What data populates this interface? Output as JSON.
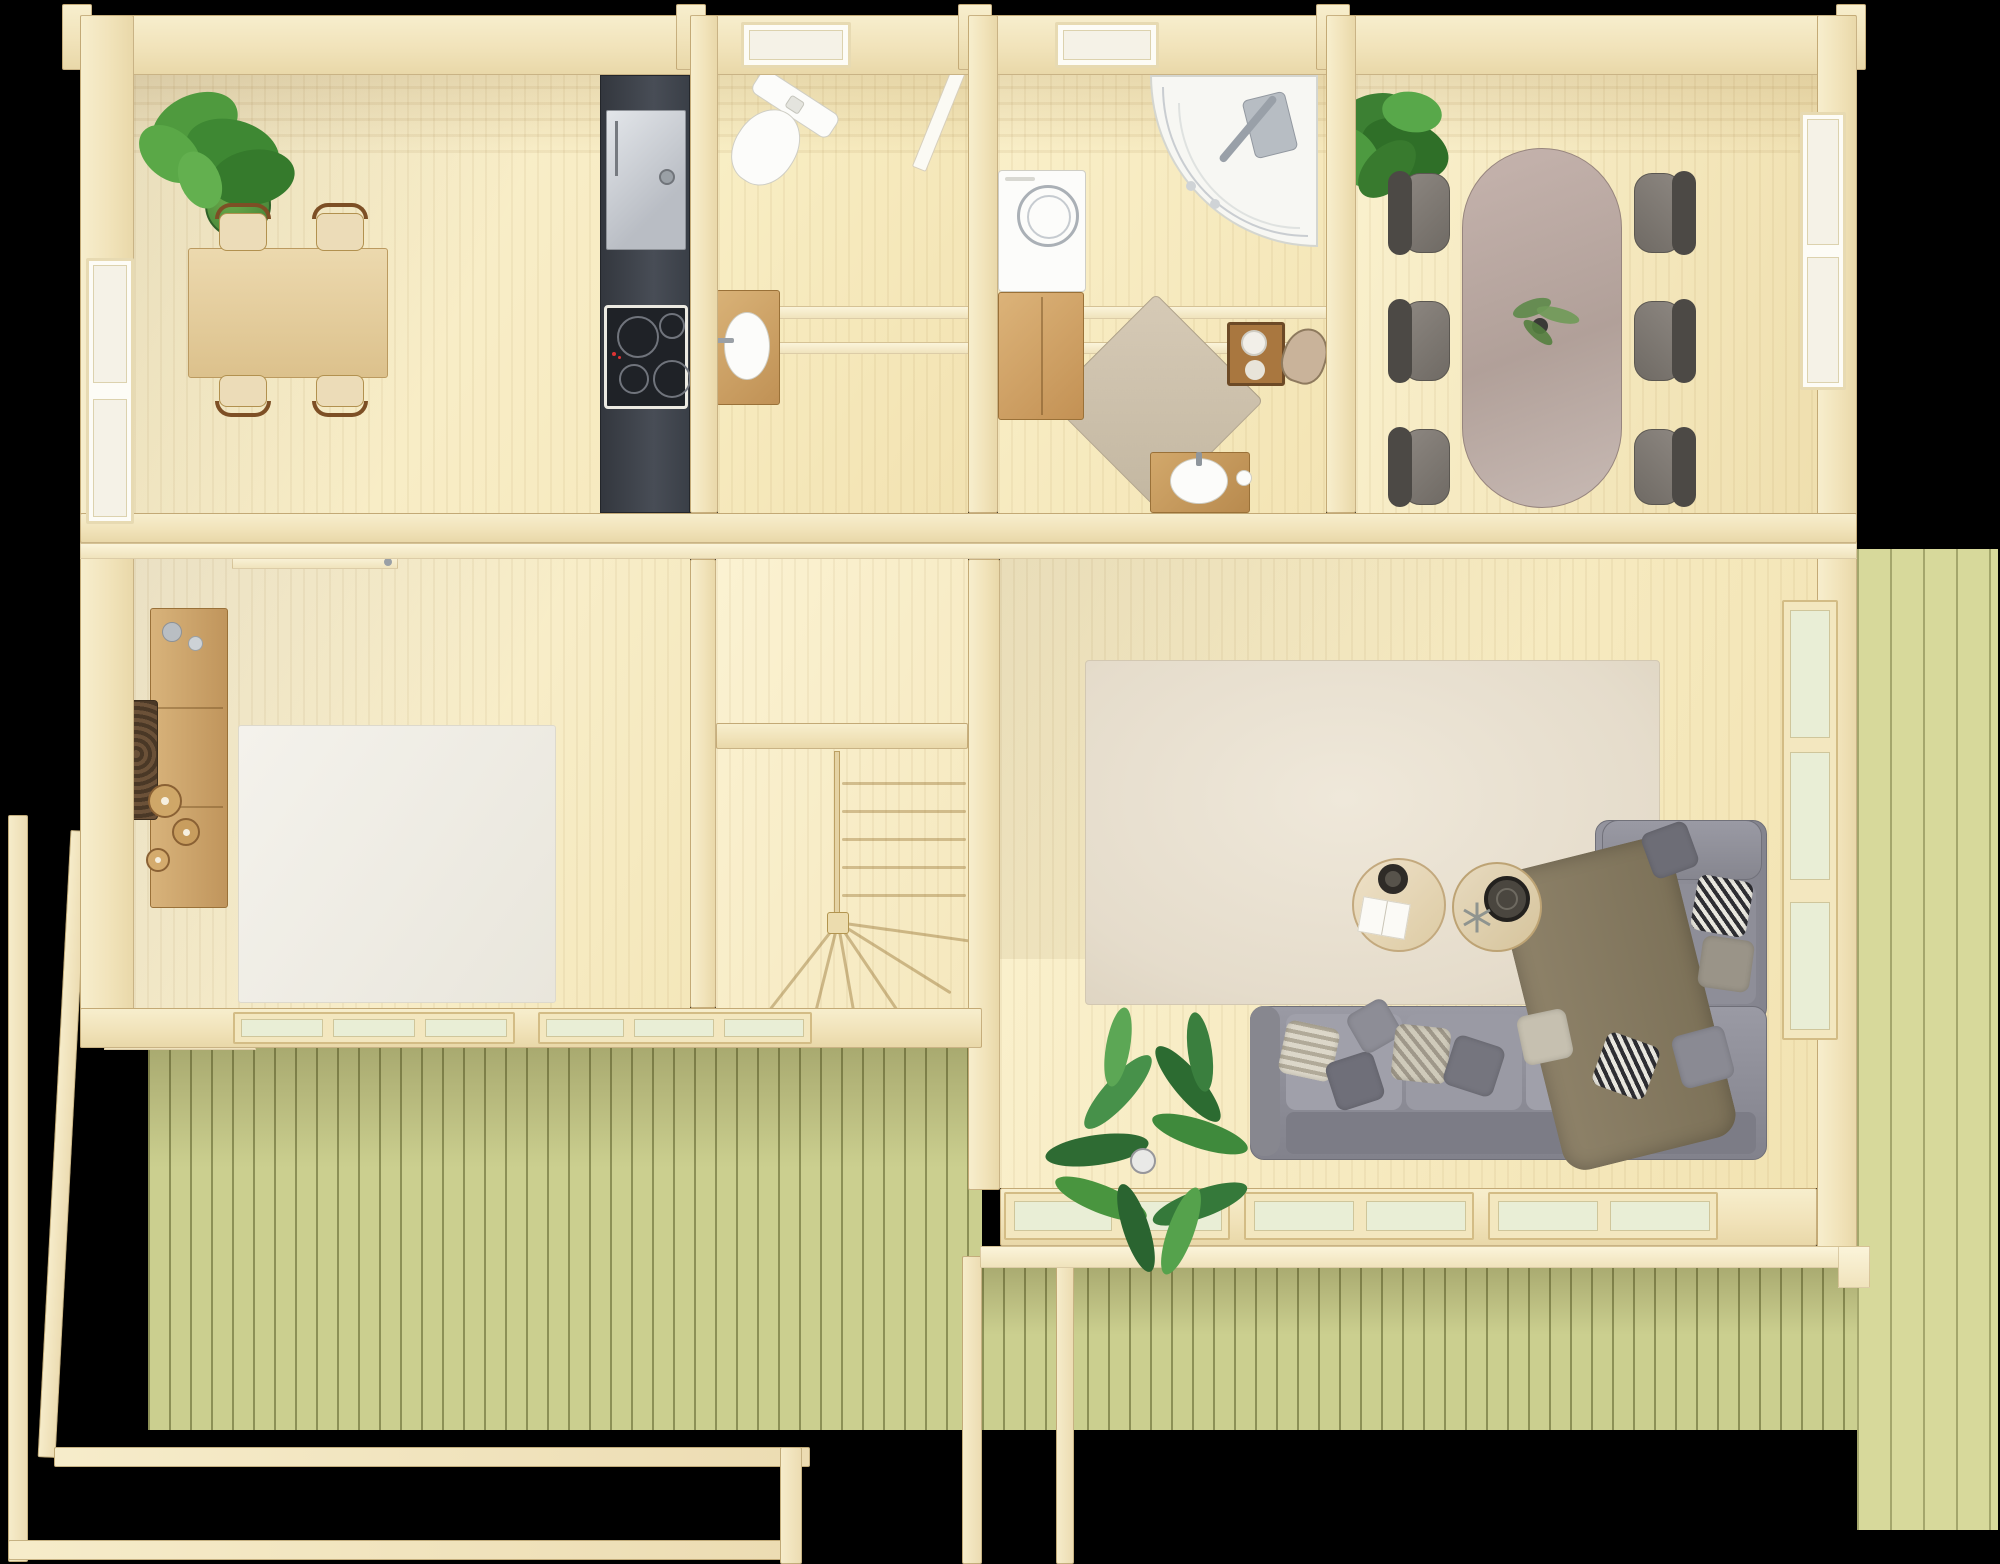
{
  "meta": {
    "title": "Log cabin floor plan - top-down 3D render",
    "view": "top-down orthographic",
    "render_style": "photoreal architectural visualization",
    "background": "#000000"
  },
  "palette": {
    "wall_timber": "#f3e7c4",
    "floor_pine": "#f8eec9",
    "deck_green": "#cbcf8f",
    "deck_green_light": "#d7d99b",
    "kitchen_unit_dark": "#3c4149",
    "fridge_steel": "#c9ccd2",
    "sofa_gray": "#8f909a",
    "dining_table_taupe": "#b7a59e",
    "chair_gray": "#847f7a",
    "wood_accent": "#c59a5f",
    "rug_living": "#eae2d4",
    "rug_bedroom": "#f1efe8",
    "rug_bath": "#cfc3ae",
    "plant_green": "#4b8f43",
    "fixture_white": "#fcfcfa"
  },
  "rooms": [
    {
      "label": "Kitchen and dining nook",
      "items": [
        "potted plant",
        "wooden dining table",
        "four chairs",
        "side window",
        "tall fridge",
        "dark kitchen unit",
        "induction hob"
      ]
    },
    {
      "label": "WC",
      "items": [
        "toilet",
        "wash basin on wooden stand",
        "drying rails",
        "top-wall window",
        "open door leaf"
      ]
    },
    {
      "label": "Bathroom",
      "items": [
        "washing machine",
        "wooden cabinet",
        "quarter-circle shower cabin",
        "diamond rug",
        "basin on wooden stool",
        "towel crates",
        "top-wall window"
      ]
    },
    {
      "label": "Dining room",
      "items": [
        "oval taupe table",
        "six upholstered chairs",
        "centerpiece plant",
        "corner potted plant",
        "right-wall window"
      ]
    },
    {
      "label": "Bedroom",
      "items": [
        "wall console with candles",
        "carved wall art",
        "white area rug",
        "sliding terrace door"
      ]
    },
    {
      "label": "Hall and staircase",
      "items": [
        "winder staircase",
        "railing with newel post",
        "sliding terrace door"
      ]
    },
    {
      "label": "Living room",
      "items": [
        "gray corner sofa",
        "scatter cushions",
        "throw blanket",
        "two round coffee tables",
        "large area rug",
        "palm plant",
        "glazed terrace doors",
        "tall right-wall window"
      ]
    }
  ],
  "outdoor": [
    {
      "label": "Left terrace deck"
    },
    {
      "label": "Back terrace deck"
    },
    {
      "label": "Right terrace deck"
    },
    {
      "label": "Pergola frame beams"
    }
  ]
}
